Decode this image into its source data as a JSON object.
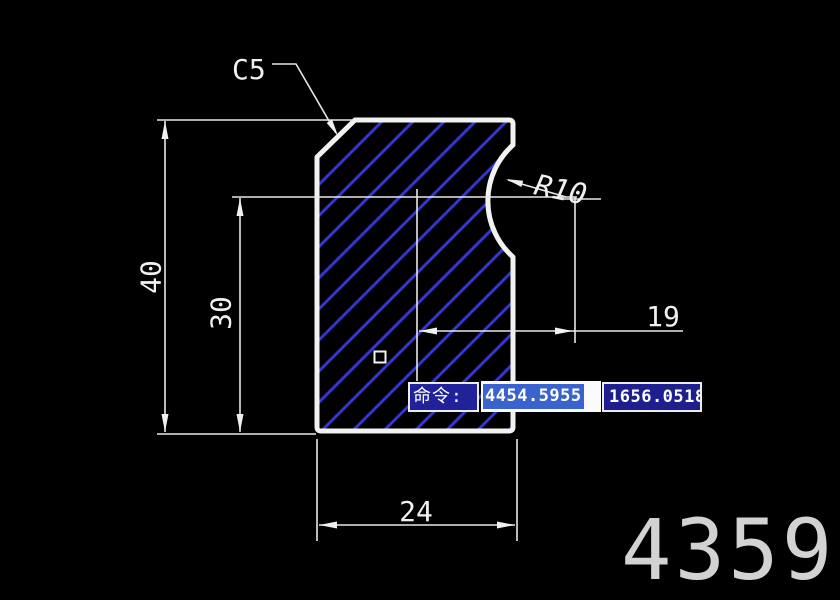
{
  "drawing": {
    "dimensions": {
      "total_height": "40",
      "inner_height": "30",
      "bottom_width": "24",
      "notch_offset": "19",
      "chamfer": "C5",
      "notch_radius": "R10"
    },
    "colors": {
      "background": "#000000",
      "outline": "#f2f2f2",
      "hatch": "#2a2ab8",
      "dim_lines": "#e8e8e8"
    }
  },
  "command_bar": {
    "prompt": "命令:",
    "coord_x": "4454.5955",
    "coord_y": "1656.0518",
    "prompt_box_color": "#21219a",
    "selection_color": "#3b63cf"
  },
  "watermark": {
    "text": "4359",
    "color": "#d2d2d2"
  }
}
